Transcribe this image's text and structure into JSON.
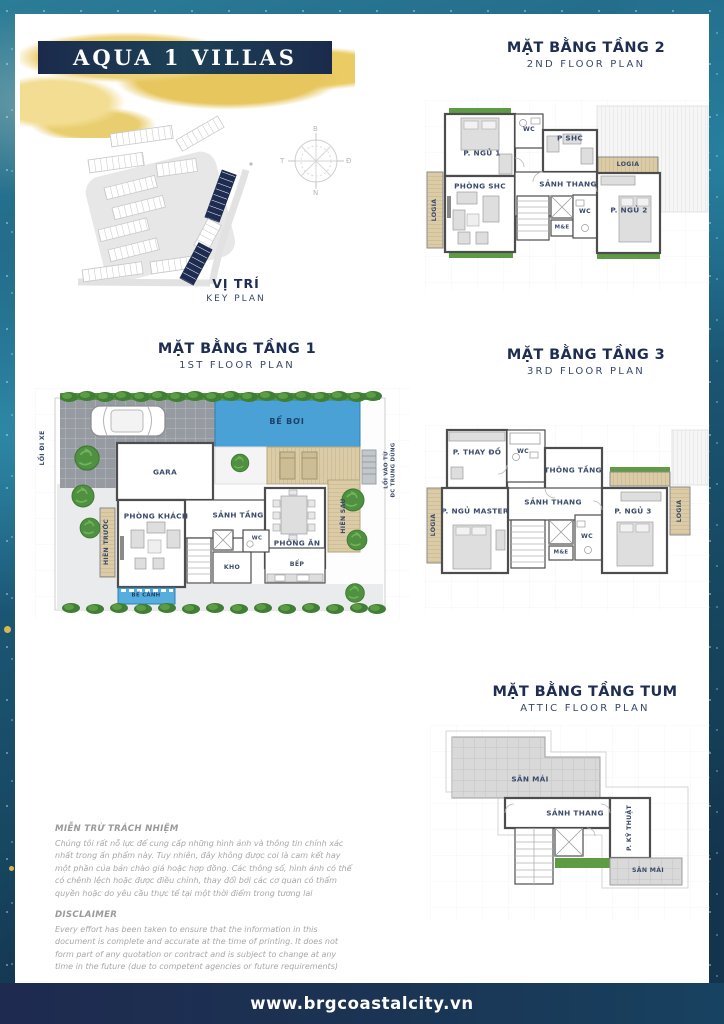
{
  "banner": {
    "title": "AQUA 1 VILLAS"
  },
  "key_plan": {
    "title_vn": "VỊ TRÍ",
    "title_en": "KEY PLAN",
    "compass": {
      "n": "B",
      "e": "Đ",
      "s": "N",
      "w": "T"
    }
  },
  "floor1": {
    "title_vn": "MẶT BẰNG TẦNG 1",
    "title_en": "1ST FLOOR PLAN",
    "rooms": {
      "gara": "GARA",
      "phong_khach": "PHÒNG KHÁCH",
      "hien_truoc": "HIÊN TRƯỚC",
      "sanh_tang": "SẢNH TẦNG",
      "kho": "KHO",
      "wc": "WC",
      "phong_an": "PHÒNG ĂN",
      "bep": "BẾP",
      "hien_sau": "HIÊN SAU",
      "be_boi": "BỂ BƠI",
      "be_canh": "BỂ CẢNH"
    },
    "site_labels": {
      "loi_di_xe": "LỐI ĐI XE",
      "loi_vao_line1": "LỐI VÀO TỪ",
      "loi_vao_line2": "ĐC TRUNG DŨNG"
    }
  },
  "floor2": {
    "title_vn": "MẶT BẰNG TẦNG 2",
    "title_en": "2ND FLOOR PLAN",
    "rooms": {
      "p_ngu_1": "P. NGỦ 1",
      "wc_1": "WC",
      "p_shc": "P SHC",
      "logia_left": "LOGIA",
      "logia_right": "LOGIA",
      "phong_shc": "PHÒNG SHC",
      "sanh_thang": "SẢNH THANG",
      "me": "M&E",
      "wc_2": "WC",
      "p_ngu_2": "P. NGỦ 2"
    }
  },
  "floor3": {
    "title_vn": "MẶT BẰNG TẦNG 3",
    "title_en": "3RD FLOOR PLAN",
    "rooms": {
      "p_thay_do": "P. THAY ĐỒ",
      "wc_1": "WC",
      "thong_tang": "THÔNG TẦNG",
      "sanh_thang": "SẢNH THANG",
      "p_ngu_master": "P. NGỦ MASTER",
      "logia_left": "LOGIA",
      "me": "M&E",
      "wc_2": "WC",
      "p_ngu_3": "P. NGỦ 3",
      "logia_right": "LOGIA"
    }
  },
  "attic": {
    "title_vn": "MẶT BẰNG TẦNG TUM",
    "title_en": "ATTIC FLOOR PLAN",
    "rooms": {
      "san_mai_1": "SÂN MÁI",
      "sanh_thang": "SẢNH THANG",
      "p_ky_thuat": "P. KỸ THUẬT",
      "san_mai_2": "SÂN MÁI"
    }
  },
  "disclaimer": {
    "vn_heading": "MIỄN TRỪ TRÁCH NHIỆM",
    "vn_body": "Chúng tôi rất nỗ lực để cung cấp những hình ảnh và thông tin chính xác nhất trong ấn phẩm này. Tuy nhiên, đây không được coi là cam kết hay một phần của bản chào giá hoặc hợp đồng. Các thông số, hình ảnh có thể có chênh lệch hoặc được điều chỉnh, thay đổi bởi các cơ quan có thẩm quyền hoặc do yêu cầu thực tế tại một thời điểm trong tương lai",
    "en_heading": "DISCLAIMER",
    "en_body": "Every effort has been taken to ensure that the information in this document is complete and accurate at the time of printing. It does not form part of any quotation or contract and is subject to change at any time in the future (due to competent agencies or future requirements)"
  },
  "footer": {
    "url": "www.brgcoastalcity.vn"
  },
  "colors": {
    "navy": "#1e2c52",
    "gold": "#e9ca61",
    "pool_blue": "#49a1d6",
    "wood": "#d8c8a4",
    "landscape_green": "#57953f"
  }
}
